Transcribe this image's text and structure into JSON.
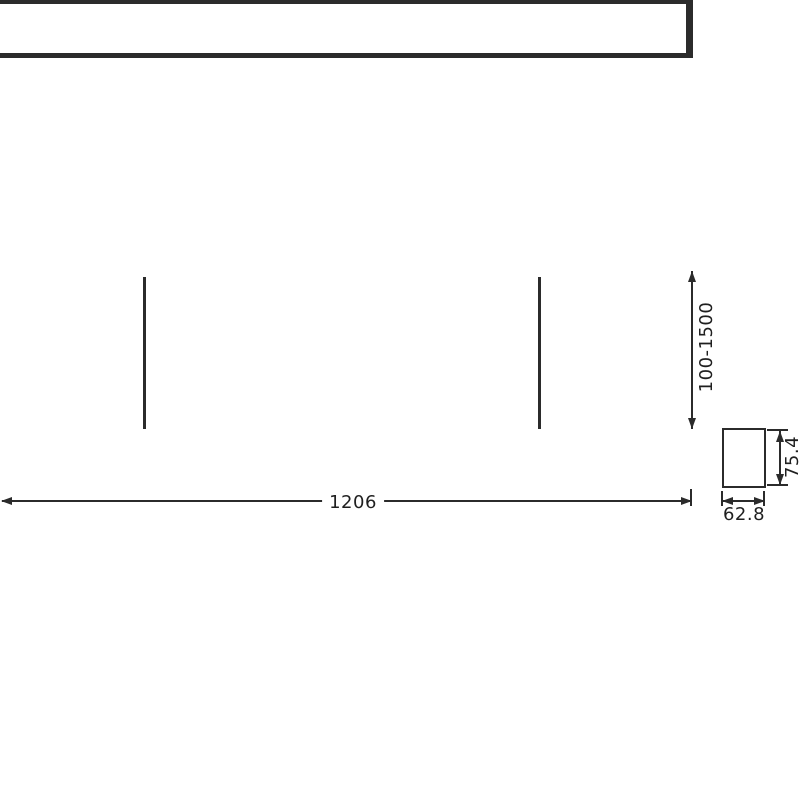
{
  "drawing": {
    "type": "technical-dimension-drawing",
    "subject": "linear pendant light fixture: side view with two suspension wires and end cross-section",
    "background_color": "#ffffff",
    "line_color": "#2b2b2b",
    "text_color": "#1f1f1f",
    "dimensions": {
      "suspension_height": {
        "label": "100-1500",
        "orientation": "vertical",
        "applies_to": "suspension wire length above fixture"
      },
      "fixture_length": {
        "label": "1206",
        "orientation": "horizontal",
        "applies_to": "fixture body length"
      },
      "profile_height": {
        "label": "75.4",
        "orientation": "vertical",
        "applies_to": "cross-section height"
      },
      "profile_width": {
        "label": "62.8",
        "orientation": "horizontal",
        "applies_to": "cross-section width"
      }
    }
  }
}
